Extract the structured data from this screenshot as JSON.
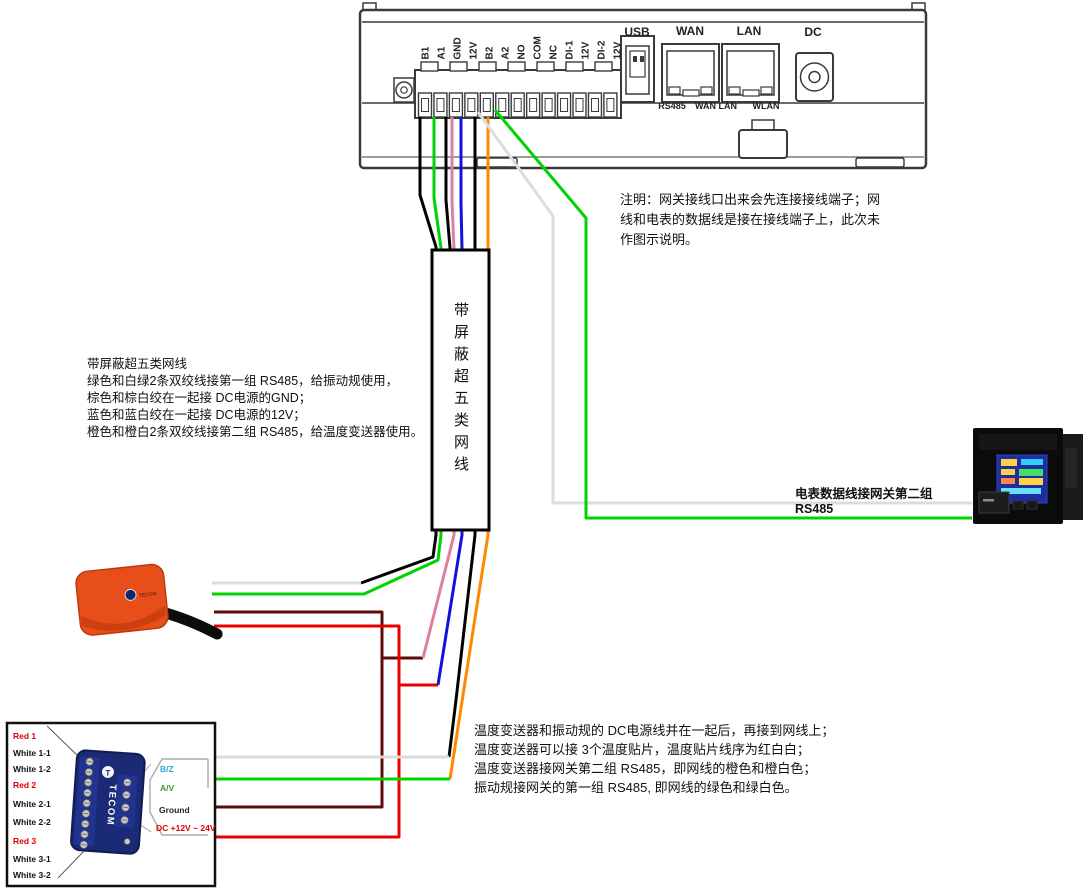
{
  "gateway": {
    "terminals": [
      "B1",
      "A1",
      "GND",
      "12V",
      "B2",
      "A2",
      "NO",
      "COM",
      "NC",
      "DI-1",
      "12V",
      "DI-2",
      "12V"
    ],
    "ports": {
      "usb": "USB",
      "wan": "WAN",
      "lan": "LAN",
      "dc": "DC"
    },
    "panel_sublabels": {
      "rs485": "RS485",
      "wan_lan": "WAN LAN",
      "wlan": "WLAN"
    }
  },
  "annotation_note": {
    "line1": "注明：网关接线口出来会先连接接线端子；网",
    "line2": "线和电表的数据线是接在接线端子上，此次未",
    "line3": "作图示说明。"
  },
  "cable": {
    "vertical_label": "带屏蔽超五类网线",
    "description": {
      "line1": "带屏蔽超五类网线",
      "line2": "绿色和白绿2条双绞线接第一组 RS485，给振动规使用，",
      "line3": "棕色和棕白绞在一起接 DC电源的GND；",
      "line4": "蓝色和蓝白绞在一起接 DC电源的12V；",
      "line5": "橙色和橙白2条双绞线接第二组 RS485，给温度变送器使用。"
    }
  },
  "meter": {
    "label": "电表数据线接网关第二组 RS485"
  },
  "bottom_note": {
    "line1": "温度变送器和振动规的 DC电源线并在一起后，再接到网线上；",
    "line2": "温度变送器可以接 3个温度贴片，温度贴片线序为红白白；",
    "line3": "温度变送器接网关第二组 RS485，即网线的橙色和橙白色；",
    "line4": "振动规接网关的第一组 RS485, 即网线的绿色和绿白色。"
  },
  "transmitter": {
    "brand": "TECOM",
    "terminal_labels": [
      "Red 1",
      "White 1-1",
      "White 1-2",
      "Red 2",
      "White 2-1",
      "White 2-2",
      "Red 3",
      "White 3-1",
      "White 3-2"
    ],
    "signal_labels": {
      "b": "B/Z",
      "a": "A/V",
      "ground": "Ground",
      "dc": "DC +12V ~ 24V"
    }
  },
  "sensor": {
    "brand": "TECOM"
  },
  "colors": {
    "wire_green": "#00d400",
    "wire_white": "#dcdcdc",
    "wire_brown_white_pink": "#dd7fa0",
    "wire_blue": "#1212dd",
    "wire_orange": "#ff8800",
    "wire_black": "#000000",
    "wire_dark_red_ground": "#5c0b0b",
    "wire_red_12v": "#e80000",
    "sensor_orange": "#e84e1a",
    "transmitter_navy": "#1a2a75",
    "label_blue": "#29a8e0",
    "label_green": "#3a9e3a",
    "label_red": "#e00000"
  }
}
